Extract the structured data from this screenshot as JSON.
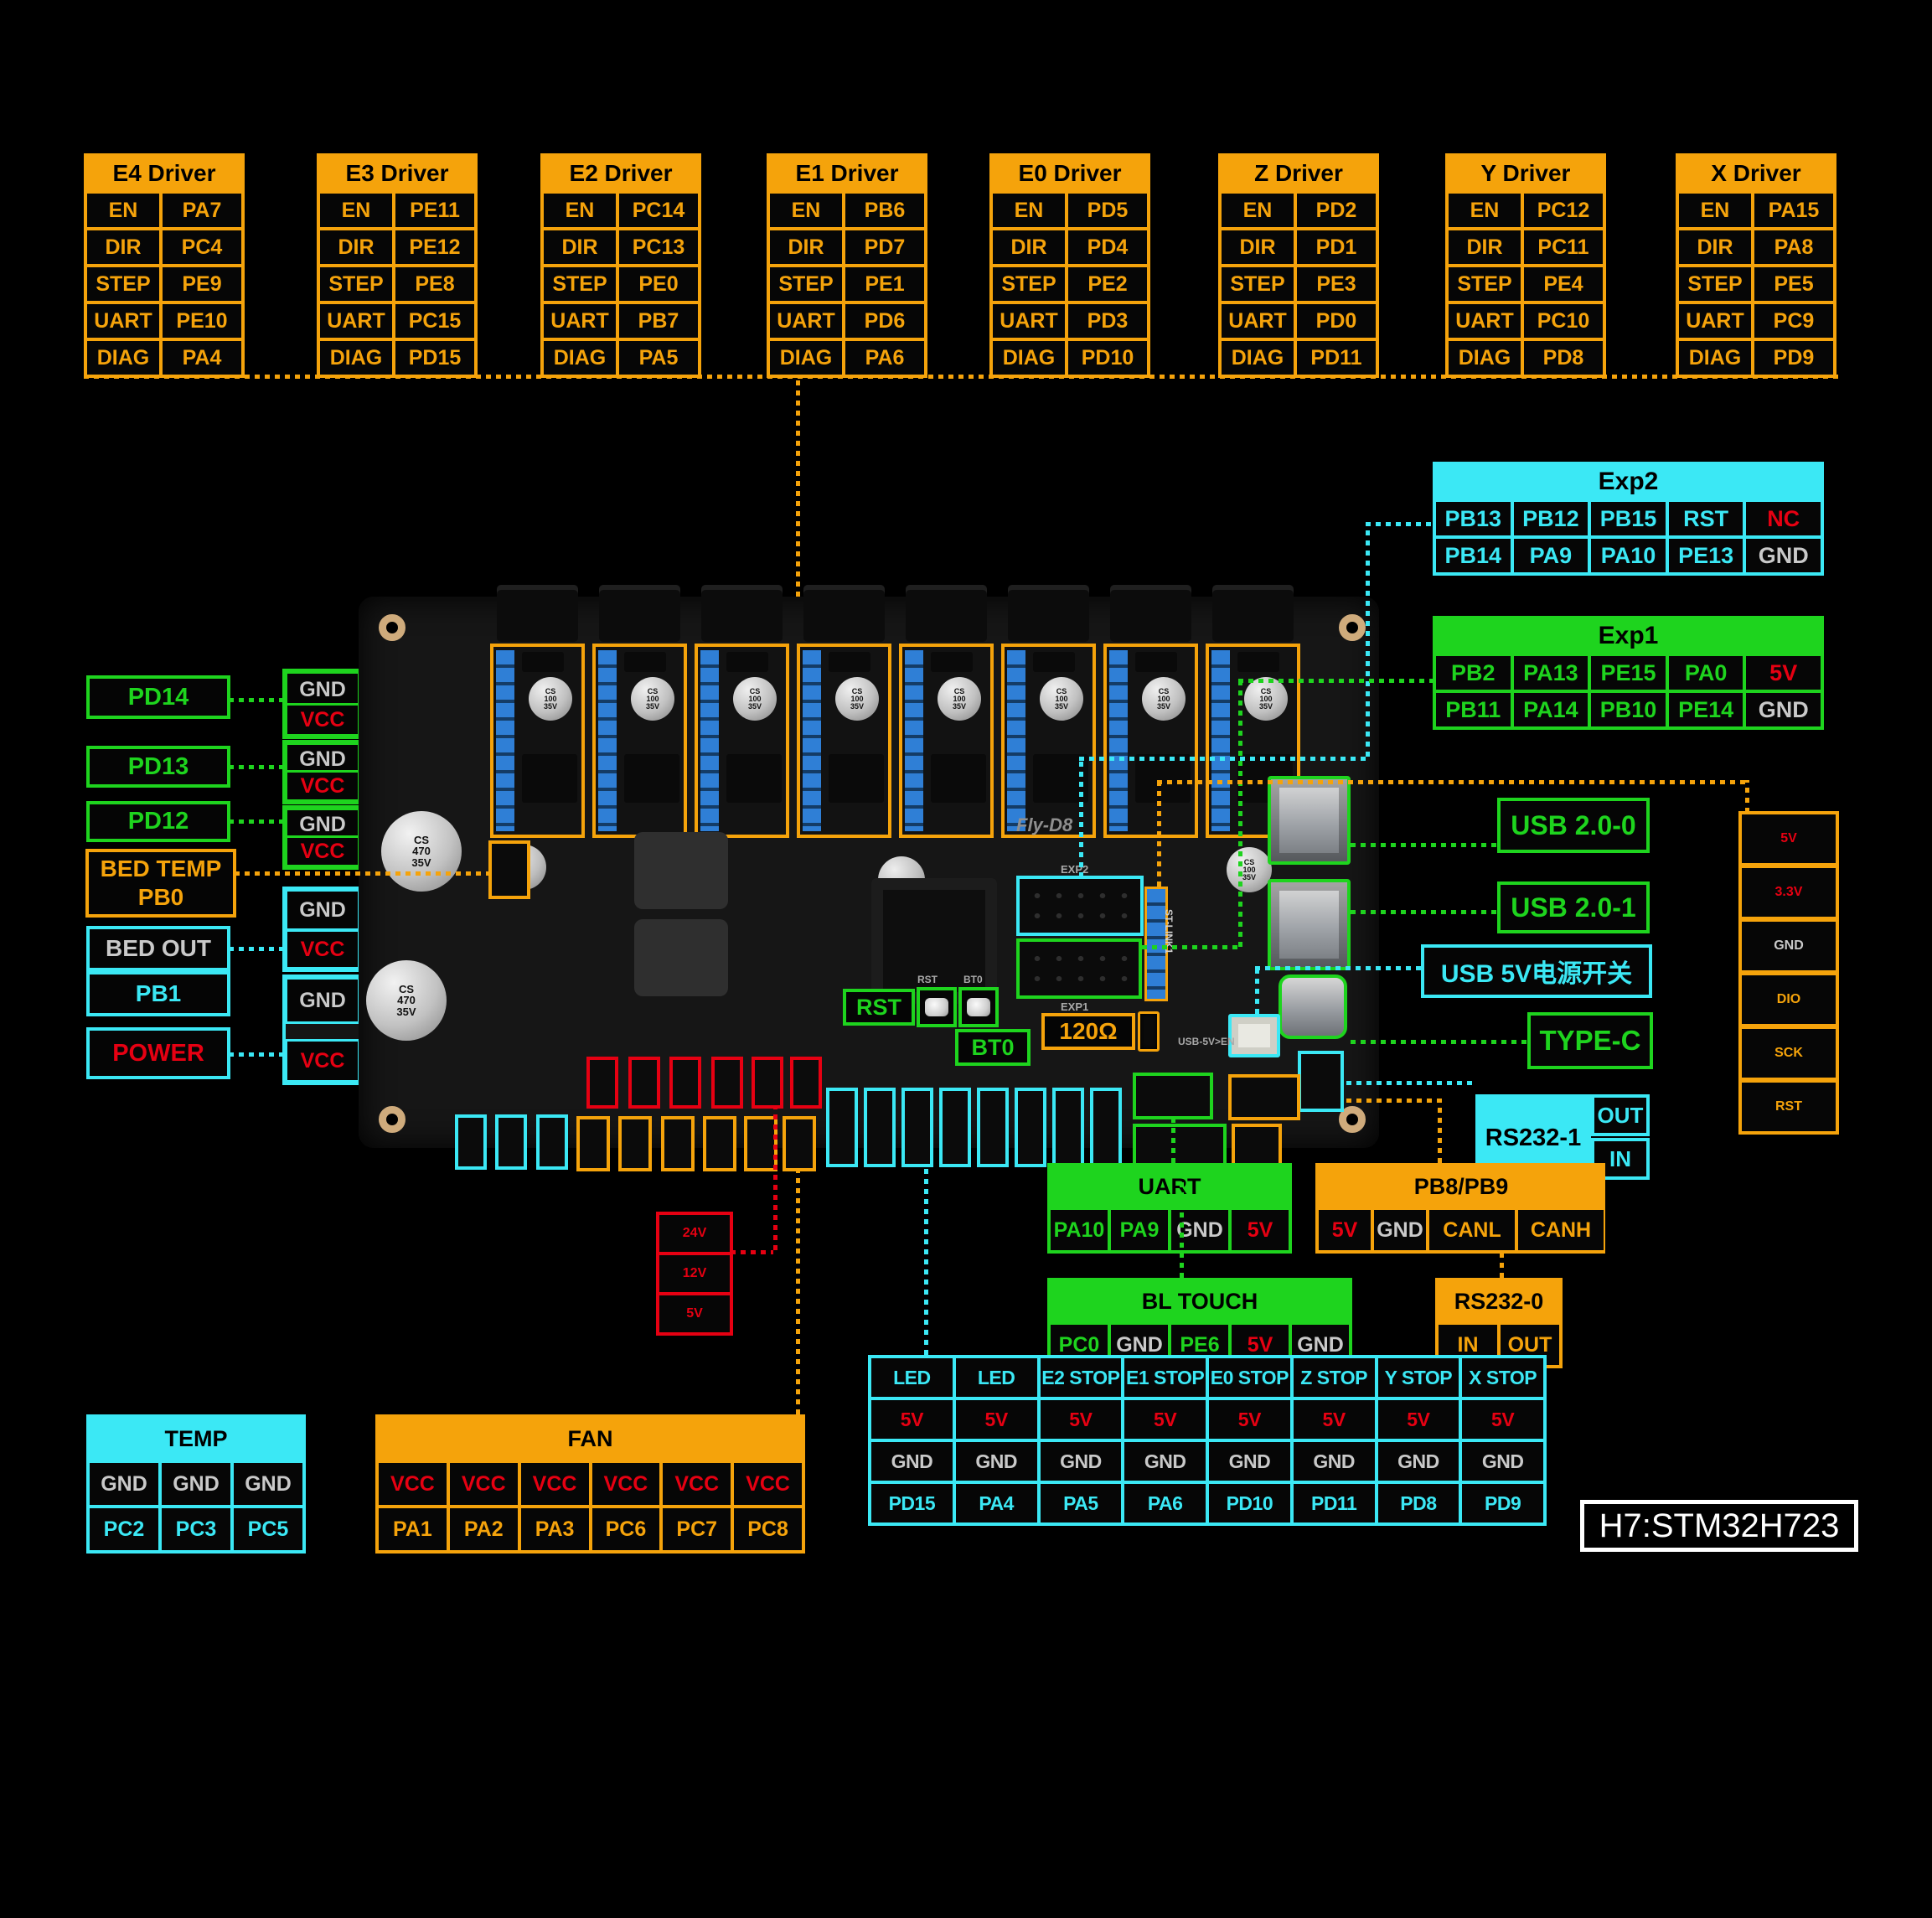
{
  "colors": {
    "orange": "#F5A30B",
    "green": "#1ED41E",
    "cyan": "#3BE8F5",
    "red": "#E60012",
    "gray": "#C9C9C9",
    "blue": "#2F7FD6",
    "white": "#FFFFFF"
  },
  "drivers": [
    {
      "name": "E4 Driver",
      "pins": [
        "EN",
        "PA7",
        "DIR",
        "PC4",
        "STEP",
        "PE9",
        "UART",
        "PE10",
        "DIAG",
        "PA4"
      ]
    },
    {
      "name": "E3 Driver",
      "pins": [
        "EN",
        "PE11",
        "DIR",
        "PE12",
        "STEP",
        "PE8",
        "UART",
        "PC15",
        "DIAG",
        "PD15"
      ]
    },
    {
      "name": "E2 Driver",
      "pins": [
        "EN",
        "PC14",
        "DIR",
        "PC13",
        "STEP",
        "PE0",
        "UART",
        "PB7",
        "DIAG",
        "PA5"
      ]
    },
    {
      "name": "E1 Driver",
      "pins": [
        "EN",
        "PB6",
        "DIR",
        "PD7",
        "STEP",
        "PE1",
        "UART",
        "PD6",
        "DIAG",
        "PA6"
      ]
    },
    {
      "name": "E0 Driver",
      "pins": [
        "EN",
        "PD5",
        "DIR",
        "PD4",
        "STEP",
        "PE2",
        "UART",
        "PD3",
        "DIAG",
        "PD10"
      ]
    },
    {
      "name": "Z Driver",
      "pins": [
        "EN",
        "PD2",
        "DIR",
        "PD1",
        "STEP",
        "PE3",
        "UART",
        "PD0",
        "DIAG",
        "PD11"
      ]
    },
    {
      "name": "Y Driver",
      "pins": [
        "EN",
        "PC12",
        "DIR",
        "PC11",
        "STEP",
        "PE4",
        "UART",
        "PC10",
        "DIAG",
        "PD8"
      ]
    },
    {
      "name": "X Driver",
      "pins": [
        "EN",
        "PA15",
        "DIR",
        "PA8",
        "STEP",
        "PE5",
        "UART",
        "PC9",
        "DIAG",
        "PD9"
      ]
    }
  ],
  "exp2": {
    "title": "Exp2",
    "pins": [
      "PB13",
      "PB12",
      "PB15",
      "RST",
      "NC",
      "PB14",
      "PA9",
      "PA10",
      "PE13",
      "GND"
    ]
  },
  "exp1": {
    "title": "Exp1",
    "pins": [
      "PB2",
      "PA13",
      "PE15",
      "PA0",
      "5V",
      "PB11",
      "PA14",
      "PB10",
      "PE14",
      "GND"
    ]
  },
  "left": {
    "pd14": "PD14",
    "pd13": "PD13",
    "pd12": "PD12",
    "bed_temp_1": "BED TEMP",
    "bed_temp_2": "PB0",
    "bed_out": "BED OUT",
    "pb1": "PB1",
    "power": "POWER",
    "gnd": "GND",
    "vcc": "VCC"
  },
  "right_ports": {
    "usb0": "USB 2.0-0",
    "usb1": "USB 2.0-1",
    "usb5v": "USB 5V电源开关",
    "typec": "TYPE-C",
    "rs232_1": {
      "label": "RS232-1",
      "out": "OUT",
      "in": "IN"
    }
  },
  "right_column": [
    "5V",
    "3.3V",
    "GND",
    "DIO",
    "SCK",
    "RST"
  ],
  "uart": {
    "title": "UART",
    "pins": [
      "PA10",
      "PA9",
      "GND",
      "5V"
    ]
  },
  "pb8pb9": {
    "title": "PB8/PB9",
    "pins": [
      "5V",
      "GND",
      "CANL",
      "CANH"
    ]
  },
  "bl_touch": {
    "title": "BL TOUCH",
    "pins": [
      "PC0",
      "GND",
      "PE6",
      "5V",
      "GND"
    ]
  },
  "rs232_0": {
    "title": "RS232-0",
    "pins": [
      "IN",
      "OUT"
    ]
  },
  "power_rail": [
    "24V",
    "12V",
    "5V"
  ],
  "temp": {
    "title": "TEMP",
    "pins": [
      "GND",
      "GND",
      "GND",
      "PC2",
      "PC3",
      "PC5"
    ]
  },
  "fan": {
    "title": "FAN",
    "pins": [
      "VCC",
      "VCC",
      "VCC",
      "VCC",
      "VCC",
      "VCC",
      "PA1",
      "PA2",
      "PA3",
      "PC6",
      "PC7",
      "PC8"
    ]
  },
  "endstops": {
    "pins": [
      "LED",
      "LED",
      "E2 STOP",
      "E1 STOP",
      "E0 STOP",
      "Z STOP",
      "Y STOP",
      "X STOP",
      "5V",
      "5V",
      "5V",
      "5V",
      "5V",
      "5V",
      "5V",
      "5V",
      "GND",
      "GND",
      "GND",
      "GND",
      "GND",
      "GND",
      "GND",
      "GND",
      "PD15",
      "PA4",
      "PA5",
      "PA6",
      "PD10",
      "PD11",
      "PD8",
      "PD9"
    ]
  },
  "mcu": "H7:STM32H723",
  "board": {
    "name": "Fly-D8",
    "rst": "RST",
    "bt0": "BT0",
    "resistor": "120Ω",
    "exp1_silk": "EXP1",
    "exp2_silk": "EXP2",
    "usb_en_silk": "USB-5V>EN",
    "stlink_silk": "ST-LINK1",
    "rst_silk": "RST",
    "bt0_silk": "BT0",
    "cap_big": "CS 470 35V",
    "cap_small": "CS 100 35V"
  }
}
